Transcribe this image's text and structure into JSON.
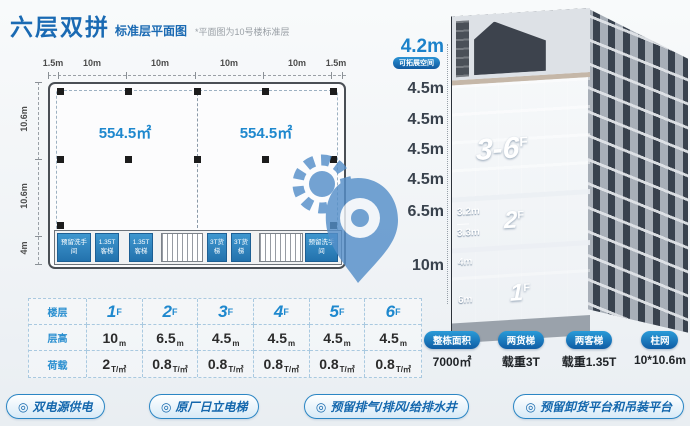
{
  "header": {
    "title": "六层双拼",
    "subtitle": "标准层平面图",
    "note": "*平面图为10号楼标准层"
  },
  "colors": {
    "accent_blue": "#1a6ab3",
    "bright_blue": "#1e88ce",
    "pill_blue": "#0f5ca4"
  },
  "plan": {
    "top_dims": [
      "1.5m",
      "10m",
      "10m",
      "10m",
      "10m",
      "1.5m"
    ],
    "side_dims": [
      "10.6m",
      "10.6m",
      "4m"
    ],
    "units": [
      "554.5㎡",
      "554.5㎡"
    ],
    "rooms": {
      "washroom": "预留洗手间",
      "lift_passenger": "1.35T客梯",
      "lift_freight": "3T货梯"
    }
  },
  "elevation": {
    "marks": [
      {
        "label": "4.2m",
        "tag": "可拓展空间"
      },
      {
        "label": "4.5m"
      },
      {
        "label": "4.5m"
      },
      {
        "label": "4.5m"
      },
      {
        "label": "4.5m"
      },
      {
        "label": "6.5m"
      },
      {
        "label": "10m"
      }
    ],
    "floors": {
      "upper": {
        "num": "3-6",
        "sup": "F"
      },
      "second": {
        "num": "2",
        "sup": "F",
        "subs": [
          "3.2m",
          "3.3m"
        ]
      },
      "first": {
        "num": "1",
        "sup": "F",
        "subs": [
          "4m",
          "6m"
        ]
      }
    }
  },
  "spec_table": {
    "row_headers": [
      "楼层",
      "层高",
      "荷载"
    ],
    "cols": [
      {
        "floor": "1",
        "sup": "F",
        "height": "10",
        "hu": "m",
        "load": "2",
        "lu": "T/㎡"
      },
      {
        "floor": "2",
        "sup": "F",
        "height": "6.5",
        "hu": "m",
        "load": "0.8",
        "lu": "T/㎡"
      },
      {
        "floor": "3",
        "sup": "F",
        "height": "4.5",
        "hu": "m",
        "load": "0.8",
        "lu": "T/㎡"
      },
      {
        "floor": "4",
        "sup": "F",
        "height": "4.5",
        "hu": "m",
        "load": "0.8",
        "lu": "T/㎡"
      },
      {
        "floor": "5",
        "sup": "F",
        "height": "4.5",
        "hu": "m",
        "load": "0.8",
        "lu": "T/㎡"
      },
      {
        "floor": "6",
        "sup": "F",
        "height": "4.5",
        "hu": "m",
        "load": "0.8",
        "lu": "T/㎡"
      }
    ]
  },
  "stats": [
    {
      "label": "整栋面积",
      "value": "7000㎡"
    },
    {
      "label": "两货梯",
      "value": "载重3T"
    },
    {
      "label": "两客梯",
      "value": "载重1.35T"
    },
    {
      "label": "柱网",
      "value": "10*10.6m"
    }
  ],
  "features": [
    {
      "icon_glyph": "◎",
      "label": "双电源供电"
    },
    {
      "icon_glyph": "◎",
      "label": "原厂日立电梯"
    },
    {
      "icon_glyph": "◎",
      "label": "预留排气/排风/给排水井"
    },
    {
      "icon_glyph": "◎",
      "label": "预留卸货平台和吊装平台"
    }
  ]
}
